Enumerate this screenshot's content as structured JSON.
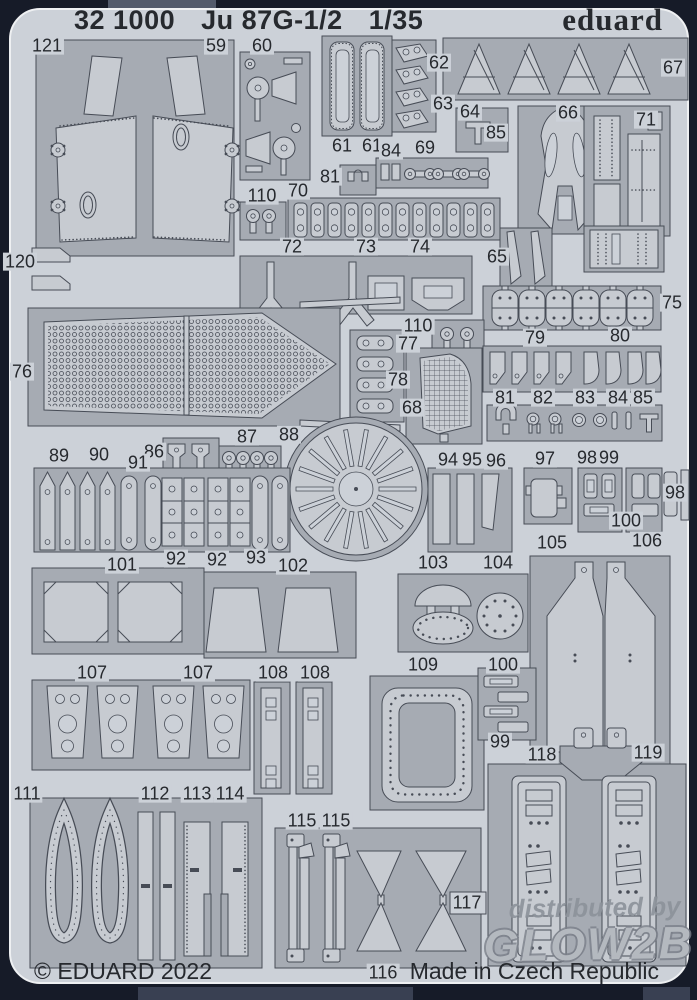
{
  "colors": {
    "photo_bg": "#161b28",
    "sheet": "#ccd1d8",
    "fret": "#a6abb3",
    "part": "#c7cbd1",
    "line": "#474c56",
    "text": "#26292e",
    "watermark": "#8d939b"
  },
  "header": {
    "catalog_number": "32 1000",
    "subject": "Ju 87G-1/2",
    "scale": "1/35",
    "brand": "eduard"
  },
  "footer": {
    "copyright": "© EDUARD 2022",
    "origin": "Made in Czech Republic"
  },
  "watermark": {
    "line1": "distributed by",
    "line2": "GLOW2B"
  },
  "part_labels": [
    {
      "text": "121",
      "x": 47,
      "y": 46
    },
    {
      "text": "59",
      "x": 216,
      "y": 46
    },
    {
      "text": "60",
      "x": 262,
      "y": 46
    },
    {
      "text": "62",
      "x": 439,
      "y": 63
    },
    {
      "text": "63",
      "x": 443,
      "y": 104
    },
    {
      "text": "67",
      "x": 673,
      "y": 68
    },
    {
      "text": "64",
      "x": 470,
      "y": 112
    },
    {
      "text": "85",
      "x": 496,
      "y": 133
    },
    {
      "text": "66",
      "x": 568,
      "y": 113
    },
    {
      "text": "71",
      "x": 646,
      "y": 120
    },
    {
      "text": "61",
      "x": 342,
      "y": 146
    },
    {
      "text": "61",
      "x": 372,
      "y": 146
    },
    {
      "text": "84",
      "x": 391,
      "y": 151
    },
    {
      "text": "69",
      "x": 425,
      "y": 148
    },
    {
      "text": "81",
      "x": 330,
      "y": 177
    },
    {
      "text": "110",
      "x": 262,
      "y": 196
    },
    {
      "text": "70",
      "x": 298,
      "y": 191
    },
    {
      "text": "120",
      "x": 20,
      "y": 262
    },
    {
      "text": "72",
      "x": 292,
      "y": 247
    },
    {
      "text": "73",
      "x": 366,
      "y": 247
    },
    {
      "text": "74",
      "x": 420,
      "y": 247
    },
    {
      "text": "65",
      "x": 497,
      "y": 257
    },
    {
      "text": "75",
      "x": 672,
      "y": 303
    },
    {
      "text": "76",
      "x": 22,
      "y": 372
    },
    {
      "text": "79",
      "x": 535,
      "y": 338
    },
    {
      "text": "80",
      "x": 620,
      "y": 336
    },
    {
      "text": "110",
      "x": 418,
      "y": 326
    },
    {
      "text": "77",
      "x": 408,
      "y": 344
    },
    {
      "text": "78",
      "x": 398,
      "y": 380
    },
    {
      "text": "68",
      "x": 412,
      "y": 408
    },
    {
      "text": "81",
      "x": 505,
      "y": 398
    },
    {
      "text": "82",
      "x": 543,
      "y": 398
    },
    {
      "text": "83",
      "x": 585,
      "y": 398
    },
    {
      "text": "84",
      "x": 618,
      "y": 398
    },
    {
      "text": "85",
      "x": 643,
      "y": 398
    },
    {
      "text": "86",
      "x": 154,
      "y": 452
    },
    {
      "text": "87",
      "x": 247,
      "y": 437
    },
    {
      "text": "88",
      "x": 289,
      "y": 435
    },
    {
      "text": "89",
      "x": 59,
      "y": 456
    },
    {
      "text": "90",
      "x": 99,
      "y": 455
    },
    {
      "text": "91",
      "x": 138,
      "y": 463
    },
    {
      "text": "94",
      "x": 448,
      "y": 460
    },
    {
      "text": "95",
      "x": 472,
      "y": 460
    },
    {
      "text": "96",
      "x": 496,
      "y": 461
    },
    {
      "text": "97",
      "x": 545,
      "y": 459
    },
    {
      "text": "98",
      "x": 587,
      "y": 458
    },
    {
      "text": "99",
      "x": 609,
      "y": 458
    },
    {
      "text": "98",
      "x": 675,
      "y": 493
    },
    {
      "text": "100",
      "x": 626,
      "y": 521
    },
    {
      "text": "92",
      "x": 176,
      "y": 559
    },
    {
      "text": "92",
      "x": 217,
      "y": 560
    },
    {
      "text": "93",
      "x": 256,
      "y": 558
    },
    {
      "text": "101",
      "x": 122,
      "y": 565
    },
    {
      "text": "102",
      "x": 293,
      "y": 566
    },
    {
      "text": "103",
      "x": 433,
      "y": 563
    },
    {
      "text": "104",
      "x": 498,
      "y": 563
    },
    {
      "text": "105",
      "x": 552,
      "y": 543
    },
    {
      "text": "106",
      "x": 647,
      "y": 541
    },
    {
      "text": "107",
      "x": 92,
      "y": 673
    },
    {
      "text": "107",
      "x": 198,
      "y": 673
    },
    {
      "text": "108",
      "x": 273,
      "y": 673
    },
    {
      "text": "108",
      "x": 315,
      "y": 673
    },
    {
      "text": "109",
      "x": 423,
      "y": 665
    },
    {
      "text": "100",
      "x": 503,
      "y": 665
    },
    {
      "text": "99",
      "x": 500,
      "y": 742
    },
    {
      "text": "118",
      "x": 542,
      "y": 755
    },
    {
      "text": "119",
      "x": 648,
      "y": 753
    },
    {
      "text": "111",
      "x": 27,
      "y": 794
    },
    {
      "text": "112",
      "x": 155,
      "y": 794
    },
    {
      "text": "113",
      "x": 197,
      "y": 794
    },
    {
      "text": "114",
      "x": 230,
      "y": 794
    },
    {
      "text": "115",
      "x": 302,
      "y": 821
    },
    {
      "text": "115",
      "x": 336,
      "y": 821
    },
    {
      "text": "117",
      "x": 467,
      "y": 903
    },
    {
      "text": "116",
      "x": 383,
      "y": 973
    }
  ]
}
